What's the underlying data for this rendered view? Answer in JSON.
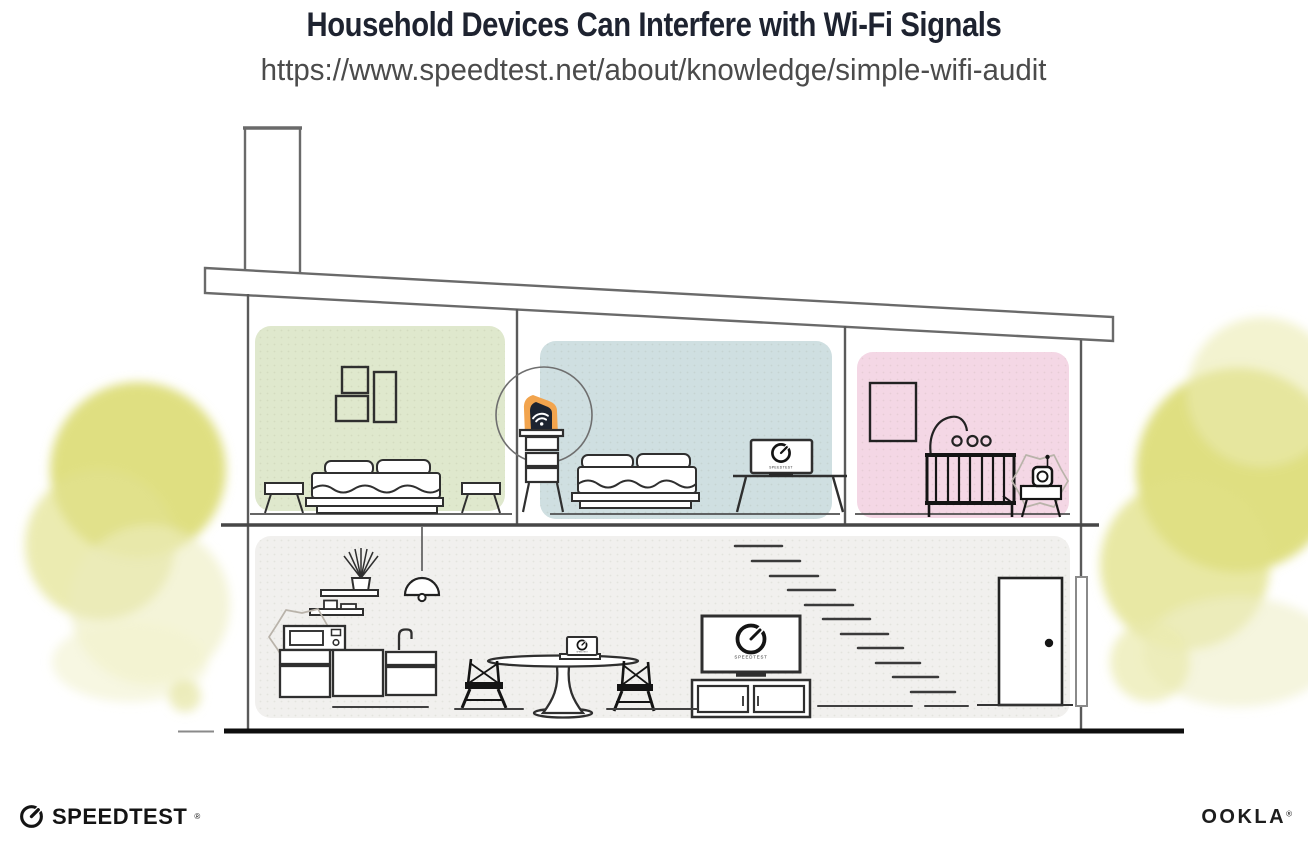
{
  "header": {
    "title": "Household Devices Can Interfere with Wi-Fi Signals",
    "url": "https://www.speedtest.net/about/knowledge/simple-wifi-audit"
  },
  "illustration": {
    "screen_label": "SPEEDTEST",
    "rooms": {
      "green": {
        "name": "bedroom-left",
        "color": "#dfe8cd"
      },
      "blue": {
        "name": "bedroom-middle",
        "color": "#cfdfe1"
      },
      "nursery": {
        "name": "nursery",
        "color": "#f4d7e5"
      },
      "main": {
        "name": "main-floor",
        "color": "#f1f0ee"
      }
    },
    "router": {
      "glow": "#f2a44d",
      "body": "#1d2430"
    },
    "palette": {
      "bush": "#dbdb74",
      "outline": "#2f2f2f",
      "structure": "#5a5a5a",
      "ground": "#0e0e0e",
      "burst": "#b9b3aa"
    }
  },
  "footer": {
    "speedtest": "SPEEDTEST",
    "ookla": "OOKLA",
    "reg": "®"
  }
}
